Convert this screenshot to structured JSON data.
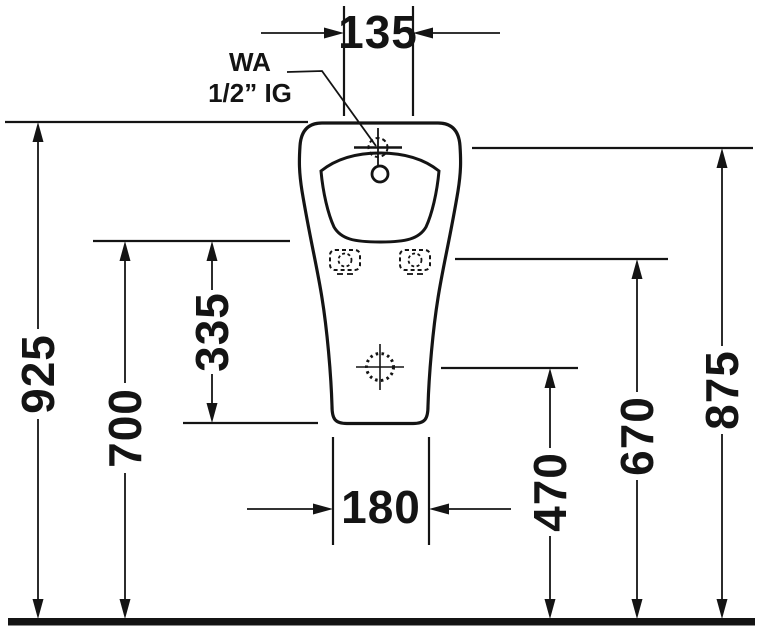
{
  "drawing": {
    "type": "technical-dimension-drawing",
    "subject": "urinal-front-view",
    "units": "mm"
  },
  "colors": {
    "line": "#141414",
    "background": "#ffffff"
  },
  "labels": {
    "tap_width": "135",
    "base_width": "180",
    "overall_height": "925",
    "rim_height": "700",
    "rim_to_base": "335",
    "outlet_height": "470",
    "fixing_height": "670",
    "inlet_height": "875"
  },
  "connection": {
    "line1": "WA",
    "line2": "1/2” IG"
  },
  "icons": {
    "tap_connection": "crosshair-dashed-circle-icon",
    "inlet_hole": "small-circle-icon",
    "fixing_holes": "dashed-fixing-hole-icon",
    "outlet": "dotted-crosshair-circle-icon",
    "ground": "thick-ground-line"
  }
}
